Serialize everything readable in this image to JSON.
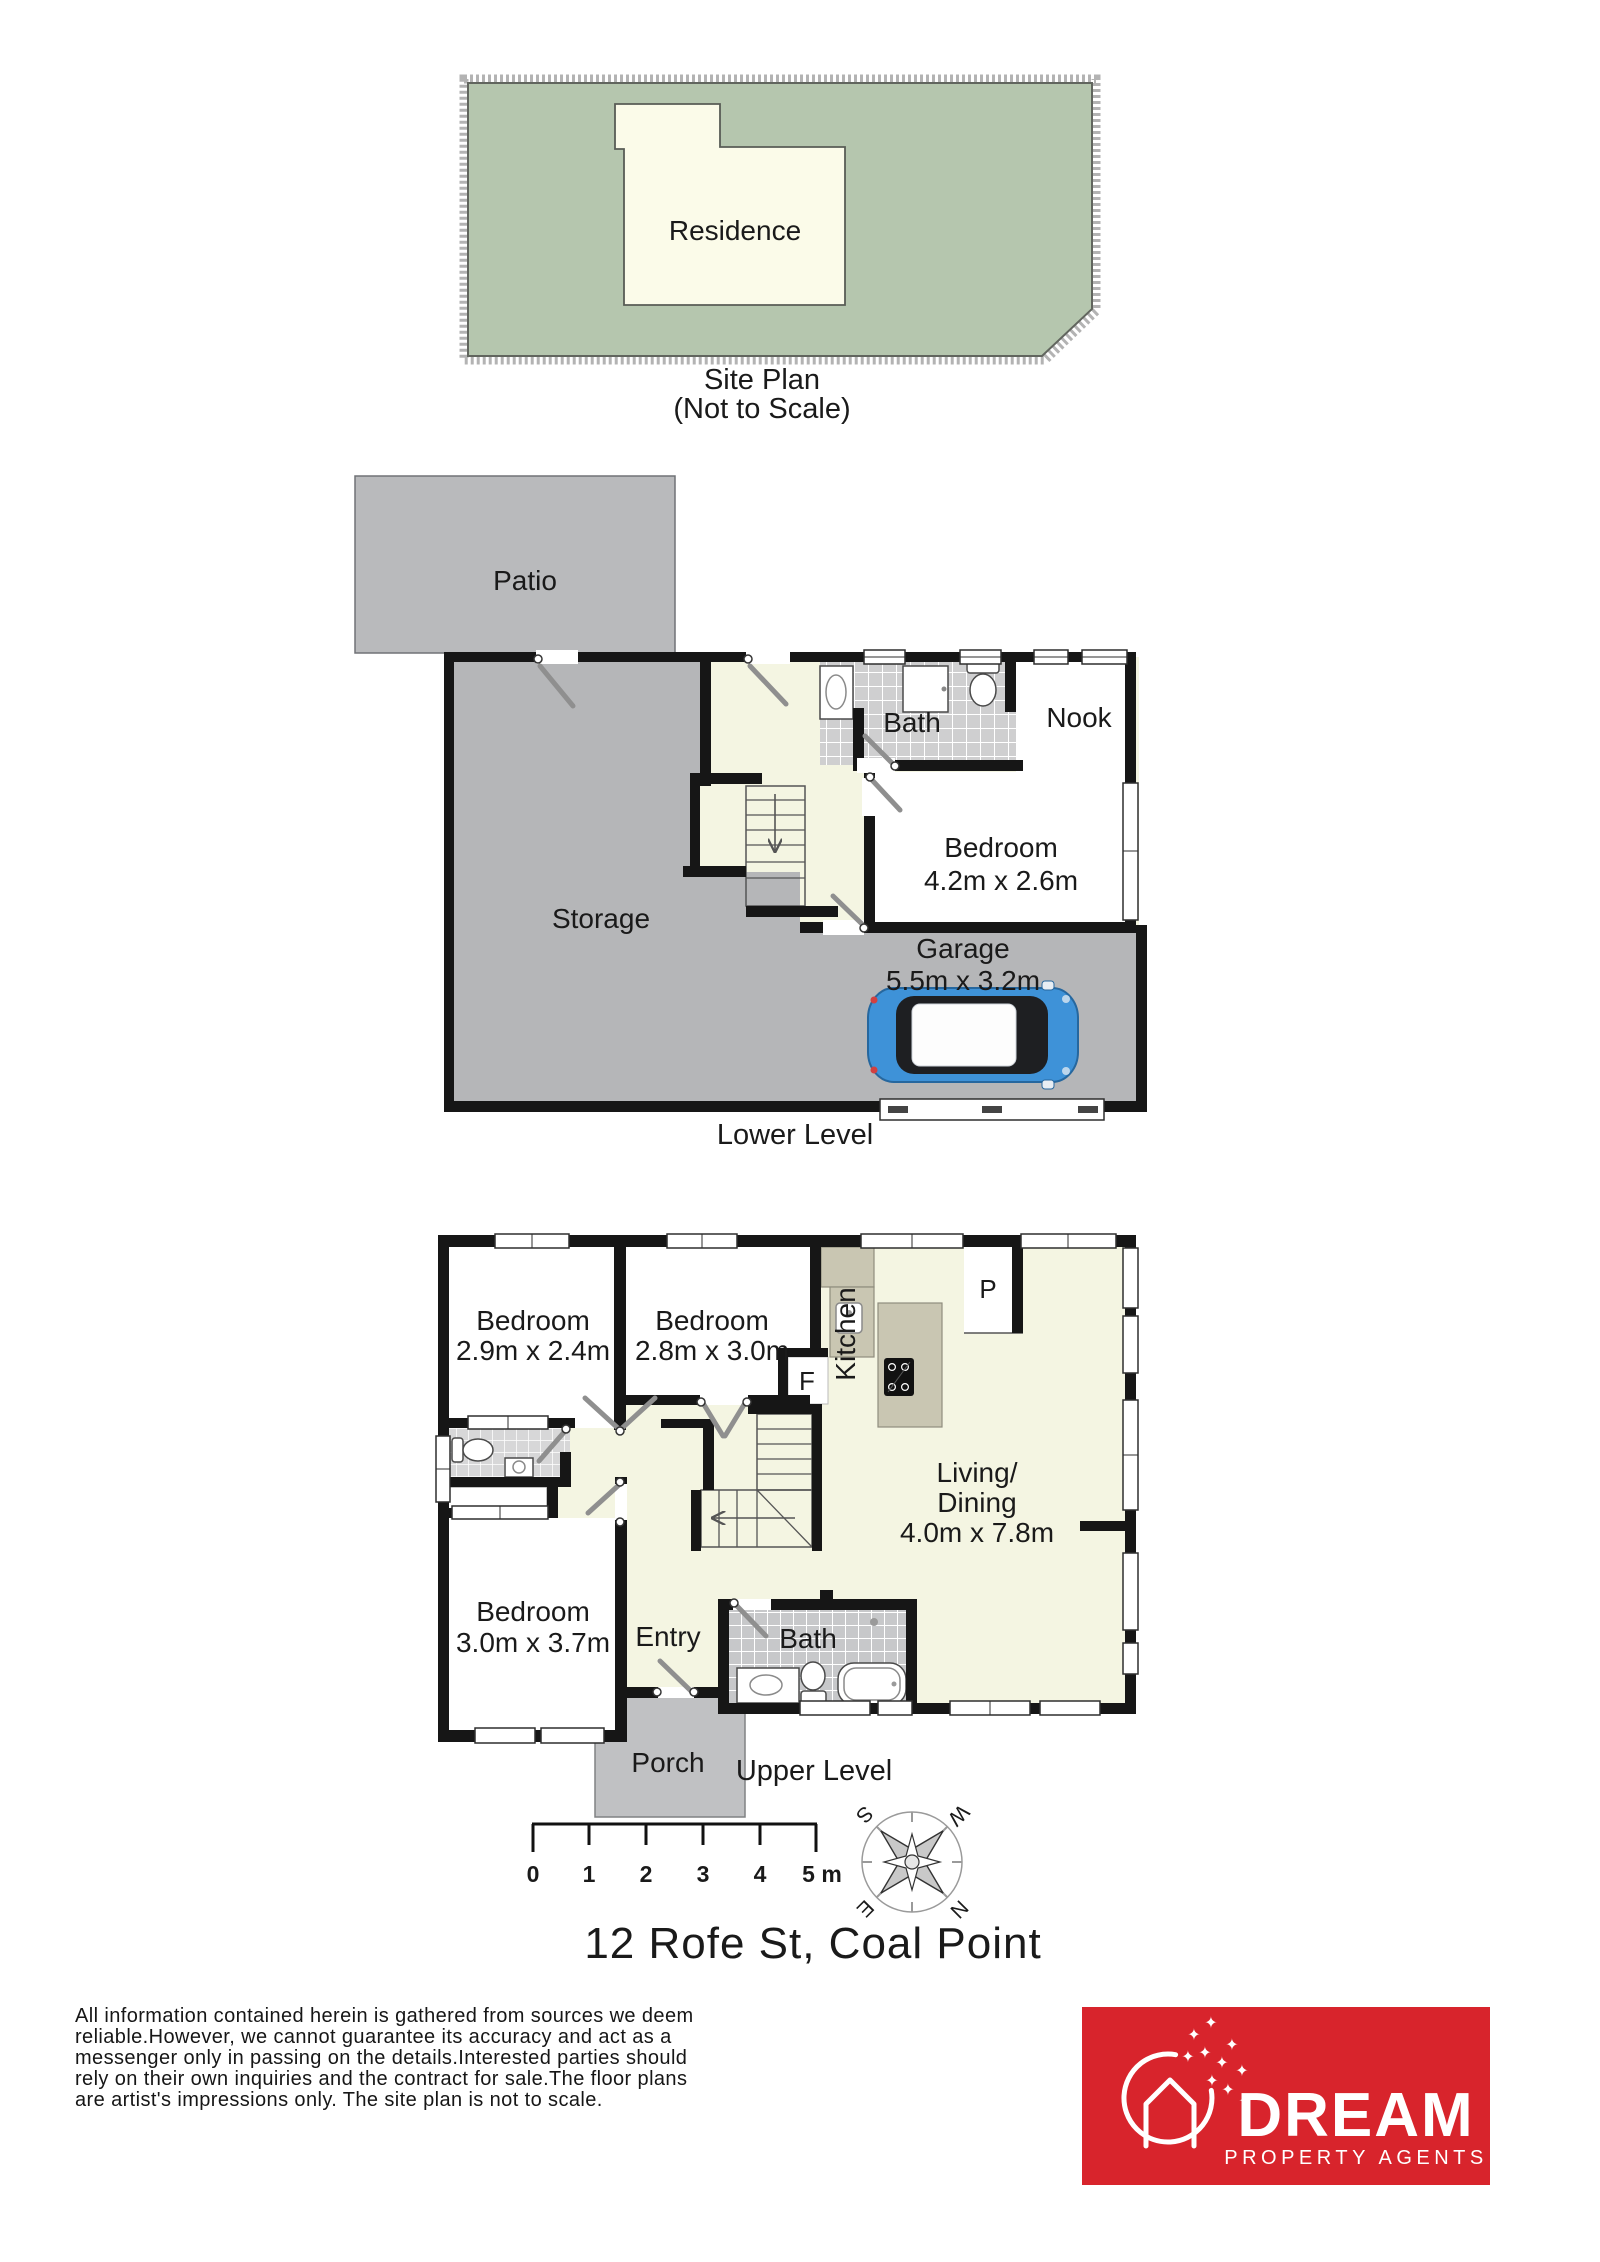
{
  "site_plan": {
    "residence": "Residence",
    "caption": "Site Plan",
    "subcaption": "(Not to Scale)"
  },
  "lower_level": {
    "caption": "Lower Level",
    "patio": "Patio",
    "storage": "Storage",
    "bath": "Bath",
    "nook": "Nook",
    "bedroom": "Bedroom",
    "bedroom_dims": "4.2m x 2.6m",
    "garage": "Garage",
    "garage_dims": "5.5m x 3.2m"
  },
  "upper_level": {
    "caption": "Upper Level",
    "bedroom1": "Bedroom",
    "bedroom1_dims": "2.9m x 2.4m",
    "bedroom2": "Bedroom",
    "bedroom2_dims": "2.8m x 3.0m",
    "bedroom3": "Bedroom",
    "bedroom3_dims": "3.0m x 3.7m",
    "kitchen": "Kitchen",
    "pantry": "P",
    "fridge": "F",
    "living1": "Living/",
    "living2": "Dining",
    "living_dims": "4.0m x 7.8m",
    "entry": "Entry",
    "bath": "Bath",
    "porch": "Porch"
  },
  "scale_bar": {
    "labels": [
      "0",
      "1",
      "2",
      "3",
      "4",
      "5 m"
    ]
  },
  "compass": {
    "n": "N",
    "e": "E",
    "s": "S",
    "w": "W"
  },
  "address": "12 Rofe St, Coal Point",
  "disclaimer": {
    "lines": [
      "All information contained herein is gathered from sources we deem",
      "reliable.However, we cannot guarantee its accuracy and act as a",
      "messenger only in passing on the details.Interested parties should",
      "rely on their own inquiries and the contract for sale.The floor plans",
      "are artist's impressions only. The site plan is not to scale."
    ]
  },
  "logo": {
    "brand": "DREAM",
    "tagline": "PROPERTY AGENTS",
    "star_glyph": "✦"
  },
  "colors": {
    "logo_red": "#d8242c",
    "site_green": "#b5c6ae",
    "residence_cream": "#fbfbe9",
    "floor_cream": "#f4f5e2",
    "concrete_gray": "#b5b6b8",
    "patio_gray": "#b9babc",
    "porch_gray": "#c0c1c3",
    "car_blue": "#3e92d8",
    "wall_black": "#161616"
  }
}
